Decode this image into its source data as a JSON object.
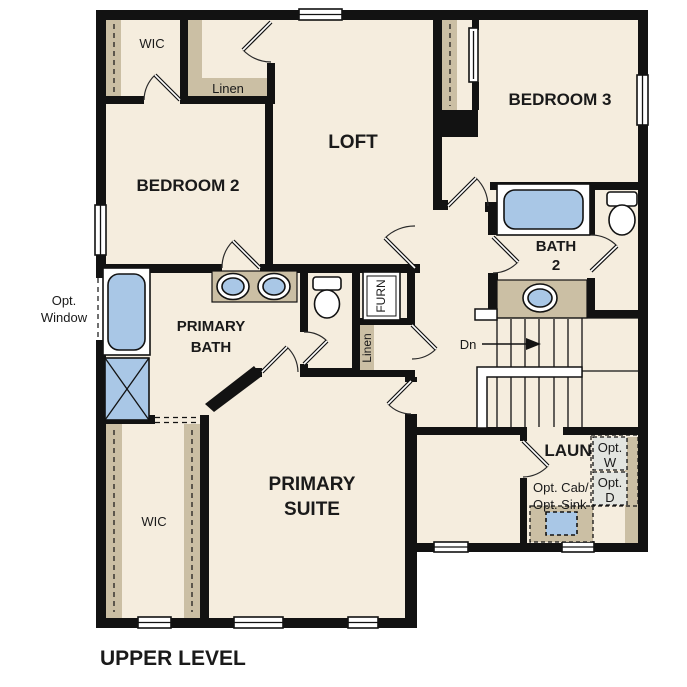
{
  "plan": {
    "title": "UPPER LEVEL",
    "labels": {
      "wic_top": "WIC",
      "linen_top": "Linen",
      "loft": "LOFT",
      "bedroom2": "BEDROOM 2",
      "bedroom3": "BEDROOM 3",
      "bath2_l1": "BATH",
      "bath2_l2": "2",
      "primary_bath_l1": "PRIMARY",
      "primary_bath_l2": "BATH",
      "primary_suite_l1": "PRIMARY",
      "primary_suite_l2": "SUITE",
      "wic_primary": "WIC",
      "laundry": "LAUN",
      "furnace": "FURN",
      "linen_mid": "Linen",
      "down": "Dn",
      "opt_window_l1": "Opt.",
      "opt_window_l2": "Window",
      "opt_washer_l1": "Opt.",
      "opt_washer_l2": "W",
      "opt_dryer_l1": "Opt.",
      "opt_dryer_l2": "D",
      "opt_cab": "Opt. Cab/",
      "opt_sink": "Opt. Sink"
    },
    "colors": {
      "wall": "#121212",
      "floor": "#f5edde",
      "counter": "#cbbfa4",
      "fixture": "#a9c7e6",
      "optional": "#e3e5e0"
    }
  }
}
